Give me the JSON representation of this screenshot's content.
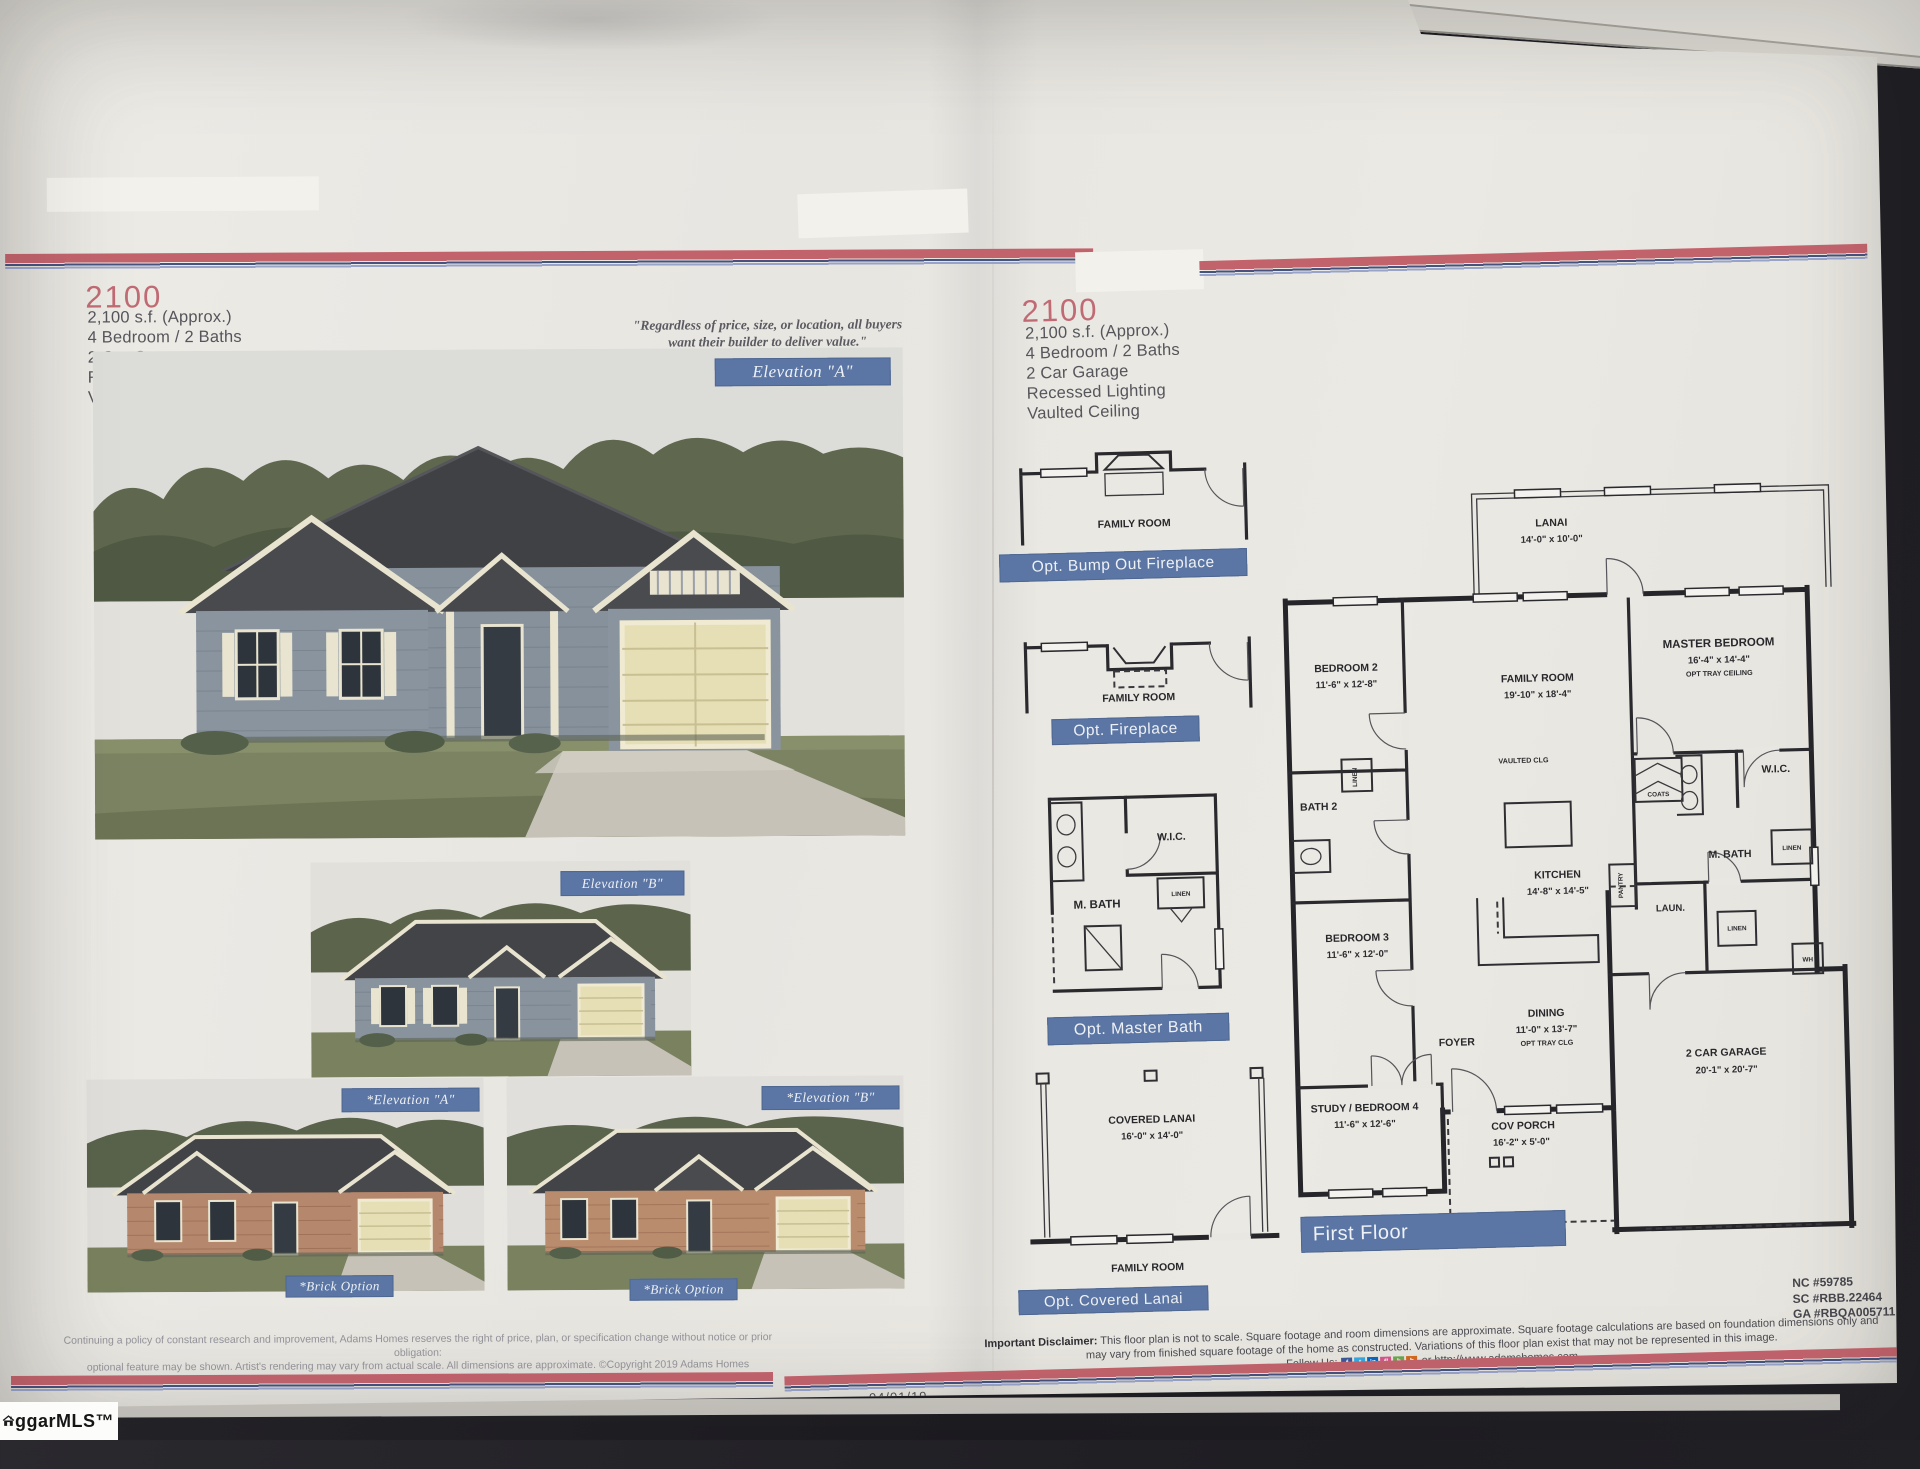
{
  "photo": {
    "watermark_text": "ggarMLS™",
    "date_left": "04/01/19",
    "date_right": "04/01/19"
  },
  "colors": {
    "accent_blue": "#5b76a4",
    "brand_red": "#c2636c",
    "heading_pink": "#c06b74"
  },
  "left_page": {
    "model": "2100",
    "specs": [
      "2,100 s.f. (Approx.)",
      "4 Bedroom / 2 Baths",
      "2 Car Garage",
      "Recessed Lighting",
      "Vaulted Ceiling"
    ],
    "quote": {
      "line1": "\"Regardless of price, size, or location, all buyers",
      "line2": "want their builder to deliver value.\"",
      "attribution": "Wayne Adams - Company Founder"
    },
    "elevation_a_label": "Elevation \"A\"",
    "elevation_b_label": "Elevation \"B\"",
    "elevation_a2_label": "*Elevation \"A\"",
    "elevation_b2_label": "*Elevation \"B\"",
    "brick_option_label": "*Brick Option",
    "fine_print1": "Continuing a policy of constant research and improvement, Adams Homes reserves the right of price, plan, or specification change without notice or prior obligation:",
    "fine_print2": "optional feature may be shown. Artist's rendering may vary from actual scale. All dimensions are approximate. ©Copyright 2019 Adams Homes"
  },
  "right_page": {
    "model": "2100",
    "specs": [
      "2,100 s.f. (Approx.)",
      "4 Bedroom / 2 Baths",
      "2 Car Garage",
      "Recessed Lighting",
      "Vaulted Ceiling"
    ],
    "options": {
      "bumpout_label": "Opt. Bump Out Fireplace",
      "fireplace_label": "Opt. Fireplace",
      "masterbath_label": "Opt. Master Bath",
      "lanai_label": "Opt. Covered Lanai",
      "family_room": "FAMILY ROOM",
      "wic": "W.I.C.",
      "mbath": "M. BATH",
      "linen": "LINEN",
      "covered_lanai_name": "COVERED LANAI",
      "covered_lanai_dim": "16'-0\" x 14'-0\""
    },
    "plan": {
      "lanai": {
        "n": "LANAI",
        "d": "14'-0\" x 10'-0\""
      },
      "bedroom2": {
        "n": "BEDROOM 2",
        "d": "11'-6\" x 12'-8\""
      },
      "family": {
        "n": "FAMILY ROOM",
        "d": "19'-10\" x 18'-4\""
      },
      "master": {
        "n": "MASTER BEDROOM",
        "d": "16'-4\" x 14'-4\"",
        "note": "OPT TRAY CEILING"
      },
      "bath2": "BATH 2",
      "linen1": "LINEN",
      "vaulted": "VAULTED CLG",
      "kitchen": {
        "n": "KITCHEN",
        "d": "14'-8\" x 14'-5\""
      },
      "coats": "COATS",
      "wic": "W.I.C.",
      "mbath": "M. BATH",
      "linen2": "LINEN",
      "pantry": "PANTRY",
      "laun": "LAUN.",
      "linen3": "LINEN",
      "wh": "WH",
      "bedroom3": {
        "n": "BEDROOM 3",
        "d": "11'-6\" x 12'-0\""
      },
      "dining": {
        "n": "DINING",
        "d": "11'-0\" x 13'-7\"",
        "note": "OPT TRAY CLG"
      },
      "foyer": "FOYER",
      "study": {
        "n": "STUDY / BEDROOM 4",
        "d": "11'-6\" x 12'-6\""
      },
      "covporch": {
        "n": "COV PORCH",
        "d": "16'-2\" x 5'-0\""
      },
      "garage": {
        "n": "2 CAR GARAGE",
        "d": "20'-1\" x 20'-7\""
      },
      "floor_label": "First Floor"
    },
    "licenses": [
      "NC #59785",
      "SC #RBB.22464",
      "GA #RBQA005711"
    ],
    "disclaimer": {
      "bold": "Important Disclaimer:",
      "line1": "This floor plan is not to scale. Square footage and room dimensions are approximate. Square footage calculations are based on foundation dimensions only and",
      "line2": "may vary from finished square footage of the home as constructed. Variations of this floor plan exist that may not be represented in this image.",
      "follow": "Follow Us:",
      "website": "or http://www.adamshomes.com"
    }
  }
}
